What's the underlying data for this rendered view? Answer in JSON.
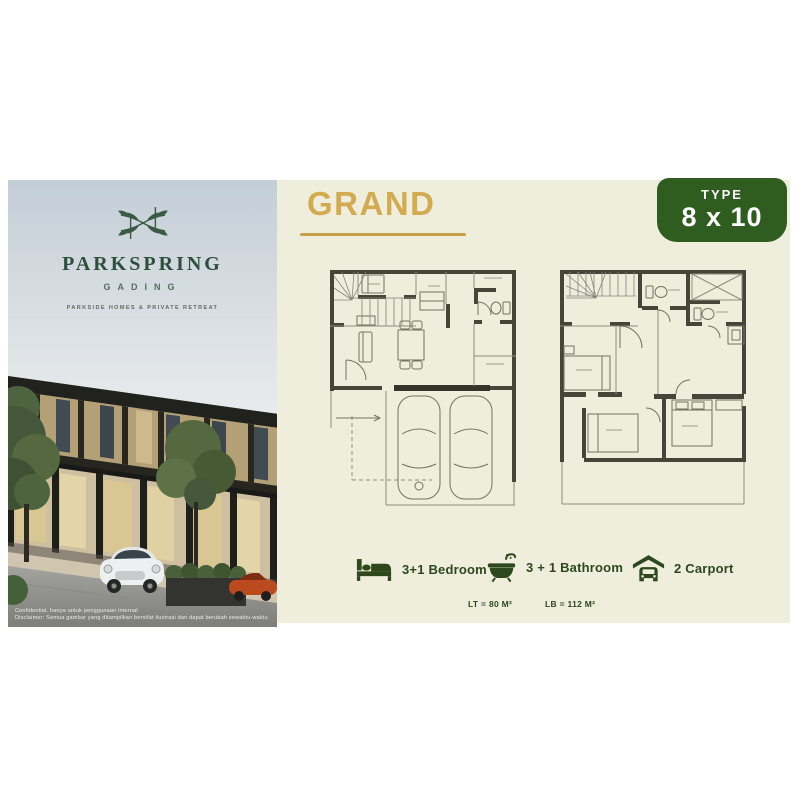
{
  "brand": {
    "logo_icon": "parkspring-leaf-monogram",
    "name": "PARKSPRING",
    "sub_name": "GADING",
    "tagline": "PARKSIDE HOMES & PRIVATE RETREAT",
    "photo_disclaimer_line1": "Confidential, hanya untuk penggunaan internal",
    "photo_disclaimer_line2": "Disclaimer: Semua gambar yang ditampilkan bersifat ilustrasi dan dapat berubah sewaktu-waktu"
  },
  "panel": {
    "title": "GRAND",
    "type_badge": {
      "label": "TYPE",
      "value": "8 x 10"
    },
    "amenities": [
      {
        "icon": "bed-icon",
        "label": "3+1 Bedroom"
      },
      {
        "icon": "bathtub-icon",
        "label": "3 + 1 Bathroom"
      },
      {
        "icon": "carport-icon",
        "label": "2 Carport"
      }
    ],
    "areas": {
      "lt": "LT = 80 M²",
      "lb": "LB = 112 M²"
    },
    "colors": {
      "panel_cream": "#efeedd",
      "badge_green": "#2f5c1f",
      "accent_gold": "#d2ab4f",
      "icon_green": "#2c481c",
      "plan_wall": "#45453a"
    }
  }
}
